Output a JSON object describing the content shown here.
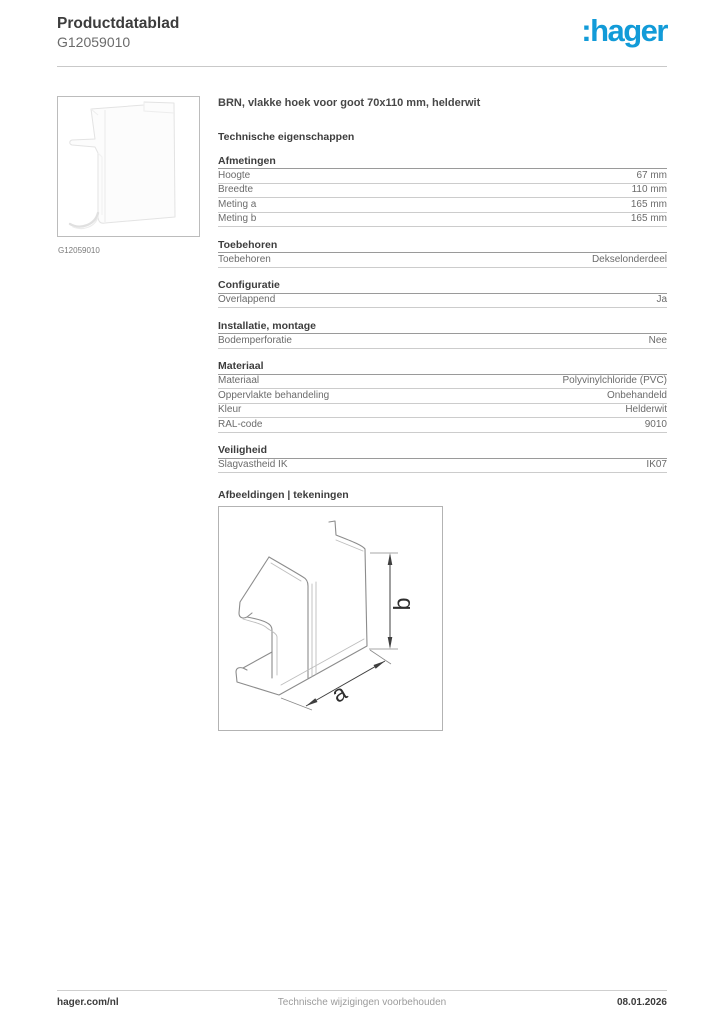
{
  "header": {
    "title": "Productdatablad",
    "reference": "G12059010",
    "logo": ":hager",
    "logo_color": "#129bd8"
  },
  "product": {
    "image_caption": "G12059010",
    "title": "BRN, vlakke hoek voor goot 70x110 mm, helderwit"
  },
  "specs": {
    "heading": "Technische eigenschappen",
    "sections": [
      {
        "title": "Afmetingen",
        "rows": [
          [
            "Hoogte",
            "67 mm"
          ],
          [
            "Breedte",
            "110 mm"
          ],
          [
            "Meting a",
            "165 mm"
          ],
          [
            "Meting b",
            "165 mm"
          ]
        ]
      },
      {
        "title": "Toebehoren",
        "rows": [
          [
            "Toebehoren",
            "Dekselonderdeel"
          ]
        ]
      },
      {
        "title": "Configuratie",
        "rows": [
          [
            "Overlappend",
            "Ja"
          ]
        ]
      },
      {
        "title": "Installatie, montage",
        "rows": [
          [
            "Bodemperforatie",
            "Nee"
          ]
        ]
      },
      {
        "title": "Materiaal",
        "rows": [
          [
            "Materiaal",
            "Polyvinylchloride (PVC)"
          ],
          [
            "Oppervlakte behandeling",
            "Onbehandeld"
          ],
          [
            "Kleur",
            "Helderwit"
          ],
          [
            "RAL-code",
            "9010"
          ]
        ]
      },
      {
        "title": "Veiligheid",
        "rows": [
          [
            "Slagvastheid IK",
            "IK07"
          ]
        ]
      }
    ]
  },
  "drawings": {
    "heading": "Afbeeldingen | tekeningen",
    "dim_a_label": "a",
    "dim_b_label": "b"
  },
  "footer": {
    "left": "hager.com/nl",
    "center": "Technische wijzigingen voorbehouden",
    "right": "08.01.2026"
  }
}
